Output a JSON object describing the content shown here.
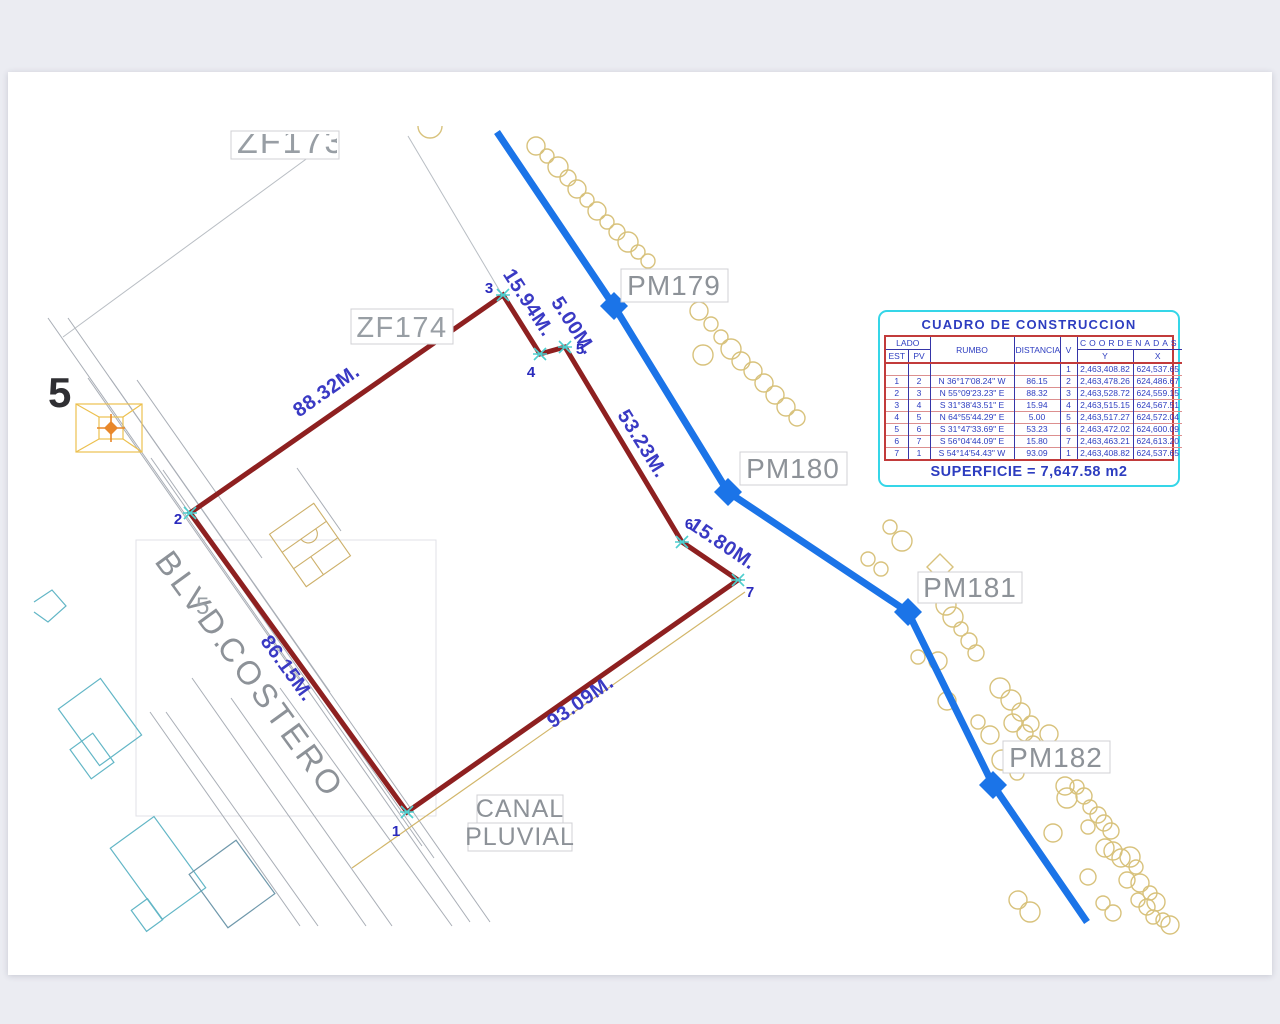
{
  "drawing": {
    "labels": {
      "zone_back": "ZF173",
      "zone_front": "ZF174",
      "pm179": "PM179",
      "pm180": "PM180",
      "pm181": "PM181",
      "pm182": "PM182",
      "blvd": "BLVD.",
      "costero": "COSTERO",
      "canal_line1": "CANAL",
      "canal_line2": "PLUVIAL",
      "street_number_large": "5",
      "street_number_small": "5"
    },
    "parcel": {
      "vertex_numbers": [
        "1",
        "2",
        "3",
        "4",
        "5",
        "6",
        "7"
      ],
      "edge_labels": [
        "88.32M.",
        "15.94M.",
        "5.00M.",
        "53.23M.",
        "15.80M.",
        "93.09M.",
        "86.15M."
      ]
    }
  },
  "table": {
    "title": "CUADRO DE CONSTRUCCION",
    "headers": {
      "lado": "LADO",
      "est": "EST",
      "pv": "PV",
      "rumbo": "RUMBO",
      "distancia": "DISTANCIA",
      "v": "V",
      "coordenadas": "COORDENADAS",
      "y": "Y",
      "x": "X"
    },
    "rows": [
      {
        "est": "",
        "pv": "",
        "rumbo": "",
        "distancia": "",
        "v": "1",
        "y": "2,463,408.82",
        "x": "624,537.65"
      },
      {
        "est": "1",
        "pv": "2",
        "rumbo": "N 36°17'08.24\" W",
        "distancia": "86.15",
        "v": "2",
        "y": "2,463,478.26",
        "x": "624,486.67"
      },
      {
        "est": "2",
        "pv": "3",
        "rumbo": "N 55°09'23.23\" E",
        "distancia": "88.32",
        "v": "3",
        "y": "2,463,528.72",
        "x": "624,559.15"
      },
      {
        "est": "3",
        "pv": "4",
        "rumbo": "S 31°38'43.51\" E",
        "distancia": "15.94",
        "v": "4",
        "y": "2,463,515.15",
        "x": "624,567.51"
      },
      {
        "est": "4",
        "pv": "5",
        "rumbo": "N 64°55'44.29\" E",
        "distancia": "5.00",
        "v": "5",
        "y": "2,463,517.27",
        "x": "624,572.04"
      },
      {
        "est": "5",
        "pv": "6",
        "rumbo": "S 31°47'33.69\" E",
        "distancia": "53.23",
        "v": "6",
        "y": "2,463,472.02",
        "x": "624,600.09"
      },
      {
        "est": "6",
        "pv": "7",
        "rumbo": "S 56°04'44.09\" E",
        "distancia": "15.80",
        "v": "7",
        "y": "2,463,463.21",
        "x": "624,613.20"
      },
      {
        "est": "7",
        "pv": "1",
        "rumbo": "S 54°14'54.43\" W",
        "distancia": "93.09",
        "v": "1",
        "y": "2,463,408.82",
        "x": "624,537.65"
      }
    ],
    "superficie": "SUPERFICIE = 7,647.58 m2"
  },
  "colors": {
    "parcel_line": "#8e2020",
    "canal_line": "#1b74e8",
    "table_border": "#35d6e8",
    "table_frame": "#c23b3b",
    "table_text": "#2d3dc0",
    "dimension_text": "#3a3ac4",
    "vegetation": "#d8c27c"
  }
}
